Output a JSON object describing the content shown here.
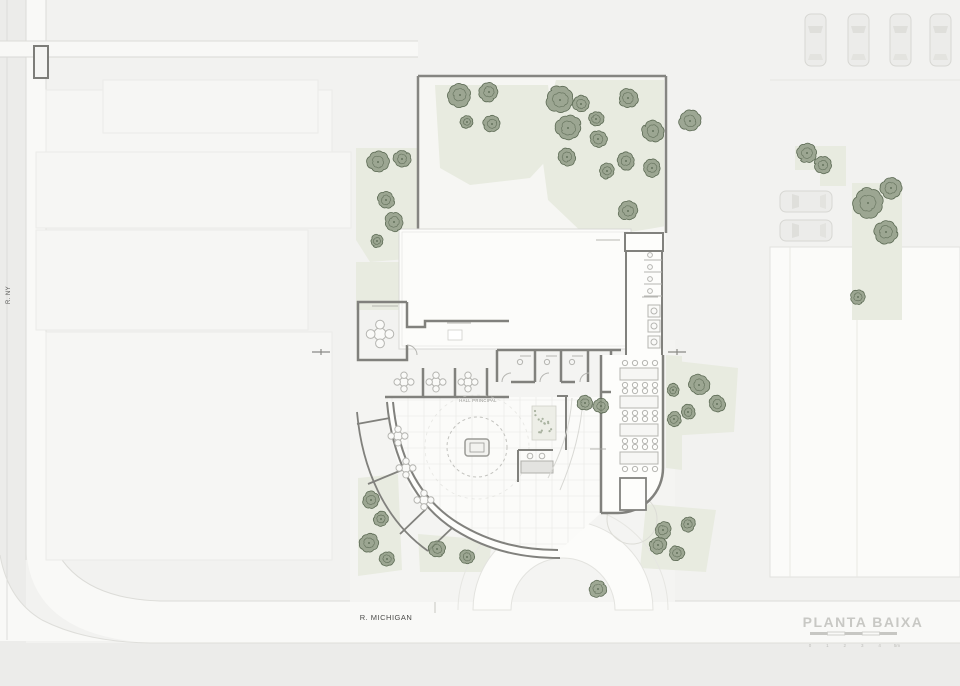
{
  "drawing": {
    "title": "PLANTA BAIXA",
    "scale_ticks": [
      "0",
      "1",
      "2",
      "3",
      "4",
      "5m"
    ],
    "streets": {
      "left": "R. NY",
      "bottom": "R. MICHIGAN"
    },
    "labels": {
      "hall": "HALL PRINCIPAL"
    },
    "colors": {
      "background": "#f2f2f0",
      "street": "#ececea",
      "sidewalk": "#fafaf8",
      "garden_green": "#e8ebe0",
      "tree_fill": "#8e9a84",
      "tree_stroke": "#5c6a54",
      "wall_dark": "#81817d",
      "furniture": "#b5b5b1",
      "title_gray": "#c8c8c4"
    }
  },
  "trees": [
    {
      "x": 460,
      "y": 95,
      "r": 11
    },
    {
      "x": 489,
      "y": 92,
      "r": 9
    },
    {
      "x": 467,
      "y": 122,
      "r": 6
    },
    {
      "x": 492,
      "y": 124,
      "r": 8
    },
    {
      "x": 560,
      "y": 100,
      "r": 13
    },
    {
      "x": 581,
      "y": 104,
      "r": 8
    },
    {
      "x": 568,
      "y": 128,
      "r": 12
    },
    {
      "x": 596,
      "y": 119,
      "r": 7
    },
    {
      "x": 598,
      "y": 139,
      "r": 8
    },
    {
      "x": 628,
      "y": 98,
      "r": 9
    },
    {
      "x": 653,
      "y": 131,
      "r": 10
    },
    {
      "x": 567,
      "y": 157,
      "r": 8
    },
    {
      "x": 626,
      "y": 161,
      "r": 8
    },
    {
      "x": 652,
      "y": 168,
      "r": 8
    },
    {
      "x": 607,
      "y": 171,
      "r": 7
    },
    {
      "x": 628,
      "y": 211,
      "r": 9
    },
    {
      "x": 690,
      "y": 121,
      "r": 10
    },
    {
      "x": 378,
      "y": 162,
      "r": 10
    },
    {
      "x": 402,
      "y": 159,
      "r": 8
    },
    {
      "x": 386,
      "y": 200,
      "r": 8
    },
    {
      "x": 394,
      "y": 222,
      "r": 9
    },
    {
      "x": 377,
      "y": 241,
      "r": 6
    },
    {
      "x": 371,
      "y": 500,
      "r": 8
    },
    {
      "x": 381,
      "y": 519,
      "r": 7
    },
    {
      "x": 369,
      "y": 543,
      "r": 9
    },
    {
      "x": 387,
      "y": 559,
      "r": 7
    },
    {
      "x": 437,
      "y": 549,
      "r": 8
    },
    {
      "x": 467,
      "y": 557,
      "r": 7
    },
    {
      "x": 699,
      "y": 385,
      "r": 10
    },
    {
      "x": 717,
      "y": 404,
      "r": 8
    },
    {
      "x": 688,
      "y": 412,
      "r": 7
    },
    {
      "x": 673,
      "y": 390,
      "r": 6
    },
    {
      "x": 674,
      "y": 419,
      "r": 7
    },
    {
      "x": 663,
      "y": 530,
      "r": 8
    },
    {
      "x": 688,
      "y": 524,
      "r": 7
    },
    {
      "x": 658,
      "y": 545,
      "r": 8
    },
    {
      "x": 677,
      "y": 553,
      "r": 7
    },
    {
      "x": 598,
      "y": 589,
      "r": 8
    },
    {
      "x": 585,
      "y": 403,
      "r": 7
    },
    {
      "x": 601,
      "y": 406,
      "r": 7
    },
    {
      "x": 807,
      "y": 153,
      "r": 9
    },
    {
      "x": 823,
      "y": 165,
      "r": 8
    },
    {
      "x": 868,
      "y": 203,
      "r": 14
    },
    {
      "x": 891,
      "y": 188,
      "r": 10
    },
    {
      "x": 886,
      "y": 232,
      "r": 11
    },
    {
      "x": 858,
      "y": 297,
      "r": 7
    }
  ],
  "green_patches": [
    {
      "d": "M 435,85 L 548,85 L 556,150 L 530,178 L 470,185 L 440,168 Z"
    },
    {
      "d": "M 556,80 L 664,80 L 664,232 L 590,240 L 548,200 L 540,140 Z"
    },
    {
      "d": "M 356,148 L 418,148 L 418,258 L 370,262 L 356,240 Z"
    },
    {
      "d": "M 356,262 L 418,262 L 418,310 L 356,310 Z"
    },
    {
      "d": "M 358,478 L 398,474 L 402,570 L 358,576 Z"
    },
    {
      "d": "M 418,534 L 492,540 L 488,572 L 420,572 Z"
    },
    {
      "d": "M 668,360 L 738,368 L 734,432 L 668,436 Z"
    },
    {
      "d": "M 646,504 L 716,510 L 706,572 L 640,568 Z"
    },
    {
      "d": "M 666,355 L 682,356 L 682,470 L 666,468 Z"
    },
    {
      "d": "M 795,146 L 846,146 L 846,186 L 820,186 L 820,170 L 795,170 Z"
    },
    {
      "d": "M 852,183 L 902,183 L 902,320 L 852,320 Z"
    }
  ],
  "cars": {
    "vertical": [
      {
        "x": 805,
        "y": 14
      },
      {
        "x": 848,
        "y": 14
      },
      {
        "x": 890,
        "y": 14
      },
      {
        "x": 930,
        "y": 14
      }
    ],
    "horizontal": [
      {
        "x": 780,
        "y": 191
      },
      {
        "x": 780,
        "y": 220
      }
    ]
  },
  "dining_tables": [
    {
      "x": 620,
      "y": 368
    },
    {
      "x": 620,
      "y": 396
    },
    {
      "x": 620,
      "y": 424
    },
    {
      "x": 620,
      "y": 452
    }
  ],
  "round_tables": [
    {
      "x": 380,
      "y": 334,
      "r": 11
    },
    {
      "x": 404,
      "y": 382,
      "r": 8
    },
    {
      "x": 436,
      "y": 382,
      "r": 8
    },
    {
      "x": 468,
      "y": 382,
      "r": 8
    },
    {
      "x": 398,
      "y": 436,
      "r": 8
    },
    {
      "x": 406,
      "y": 468,
      "r": 8
    },
    {
      "x": 424,
      "y": 500,
      "r": 8
    }
  ],
  "label_marks": [
    {
      "x1": 372,
      "y1": 306,
      "x2": 398,
      "y2": 306
    },
    {
      "x1": 447,
      "y1": 323,
      "x2": 471,
      "y2": 323
    },
    {
      "x1": 596,
      "y1": 240,
      "x2": 620,
      "y2": 240
    },
    {
      "x1": 642,
      "y1": 297,
      "x2": 658,
      "y2": 297
    },
    {
      "x1": 590,
      "y1": 449,
      "x2": 606,
      "y2": 449
    },
    {
      "x1": 520,
      "y1": 356,
      "x2": 531,
      "y2": 356
    },
    {
      "x1": 546,
      "y1": 356,
      "x2": 557,
      "y2": 356
    },
    {
      "x1": 572,
      "y1": 356,
      "x2": 583,
      "y2": 356
    }
  ]
}
